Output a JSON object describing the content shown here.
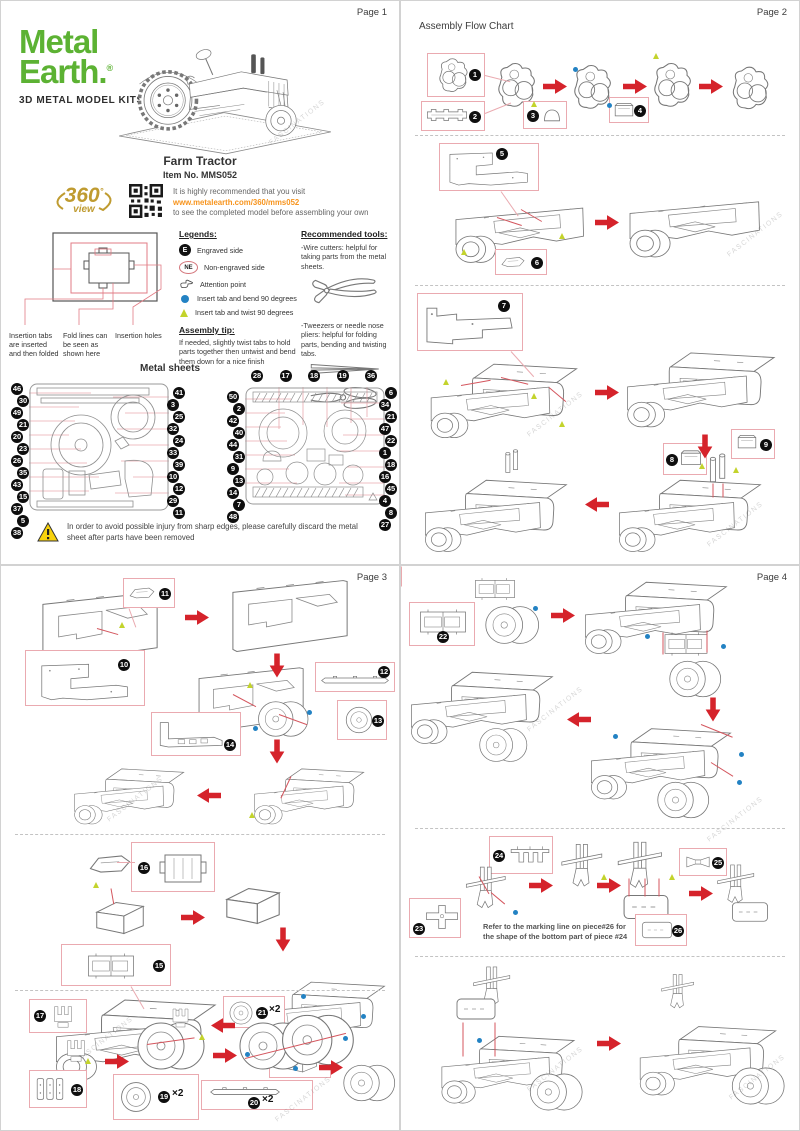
{
  "watermark": "FASCINATIONS",
  "pages": {
    "p1": "Page 1",
    "p2": "Page 2",
    "p3": "Page 3",
    "p4": "Page 4"
  },
  "page1": {
    "brand": {
      "metal": "Metal",
      "earth": "Earth.",
      "reg": "®",
      "tagline": "3D METAL MODEL KITS"
    },
    "product_name": "Farm Tractor",
    "item_no": "Item No. MMS052",
    "badge360": {
      "big": "360",
      "deg": "°",
      "view": "view"
    },
    "visit_line1": "It is highly recommended that you visit",
    "visit_url": "www.metalearth.com/360/mms052",
    "visit_line2": "to see the completed model before assembling your own",
    "insertion_label1": "Insertion tabs are inserted and then folded",
    "insertion_label2": "Fold lines can be seen as shown here",
    "insertion_label3": "Insertion holes",
    "legends_title": "Legends:",
    "legend_e_symbol": "E",
    "legend_e": "Engraved side",
    "legend_ne_symbol": "NE",
    "legend_ne": "Non-engraved side",
    "legend_attention": "Attention point",
    "legend_dot": "Insert tab and bend 90 degrees",
    "legend_triangle": "Insert tab and twist 90 degrees",
    "tip_title": "Assembly tip:",
    "tip_text": "If needed, slightly twist tabs to hold parts together then untwist and bend them down for a nice finish",
    "tools_title": "Recommended tools:",
    "tool1": "-Wire cutters: helpful for taking parts from the metal sheets.",
    "tool2": "-Tweezers or needle nose pliers: helpful for folding parts, bending and twisting tabs.",
    "metal_sheets_title": "Metal sheets",
    "sheet1_left": [
      "46",
      "30",
      "49",
      "21",
      "20",
      "23",
      "26",
      "35",
      "43",
      "15",
      "37",
      "5",
      "38"
    ],
    "sheet1_right": [
      "41",
      "3",
      "25",
      "32",
      "24",
      "33",
      "39",
      "10",
      "12",
      "29",
      "11"
    ],
    "sheet2_top": [
      "28",
      "17",
      "18",
      "19",
      "36"
    ],
    "sheet2_left": [
      "50",
      "2",
      "42",
      "40",
      "44",
      "31",
      "9",
      "13",
      "14",
      "7",
      "48"
    ],
    "sheet2_right": [
      "6",
      "34",
      "21",
      "47",
      "22",
      "1",
      "18",
      "16",
      "45",
      "4",
      "8",
      "27"
    ],
    "warning": "In order to avoid possible injury from sharp edges, please carefully discard the metal sheet after parts have been removed"
  },
  "page2": {
    "title": "Assembly Flow Chart",
    "steps": [
      "1",
      "2",
      "3",
      "4",
      "5",
      "6",
      "7",
      "8",
      "9"
    ]
  },
  "page3": {
    "steps": [
      "10",
      "11",
      "12",
      "13",
      "14",
      "15",
      "16",
      "17",
      "18",
      "19",
      "20",
      "21"
    ],
    "x2": "×2"
  },
  "page4": {
    "steps": [
      "22",
      "23",
      "24",
      "25",
      "26"
    ],
    "note1": "Refer to the marking line on piece#26 for",
    "note2": "the shape of the bottom part of piece #24"
  },
  "colors": {
    "brand_green": "#5cb233",
    "gold": "#bf9b30",
    "url_orange": "#f7941d",
    "arrow_red": "#d5232b",
    "box_pink": "#eaaab0",
    "dot_blue": "#2382c3",
    "twist_yellow_green": "#c3d32c"
  }
}
